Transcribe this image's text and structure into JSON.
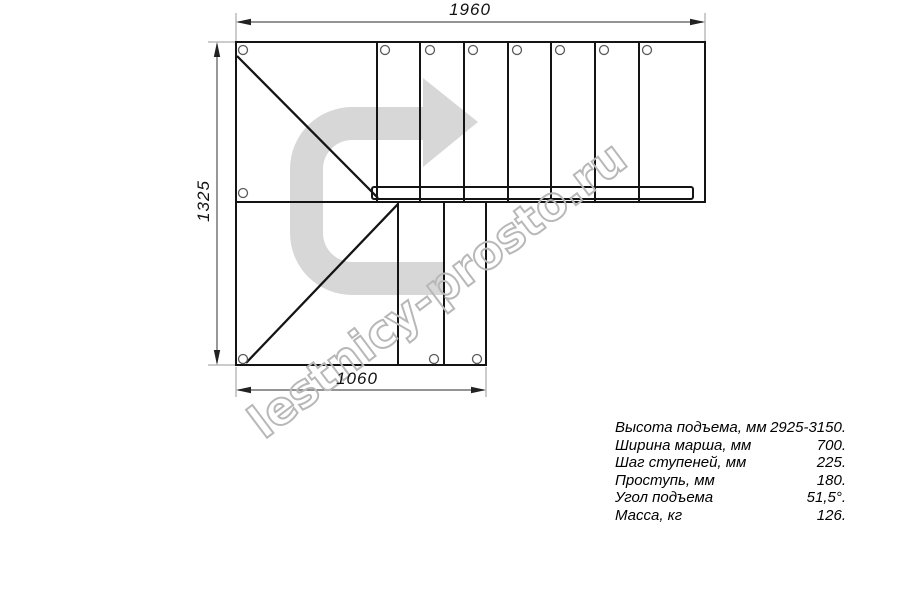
{
  "drawing": {
    "title": "Staircase plan view (L-shaped, top view)",
    "dimensions": {
      "top": "1960",
      "left": "1325",
      "bottom": "1060"
    },
    "watermark_text": "lestnicy-prosto.ru",
    "colors": {
      "line": "#141414",
      "arrow_watermark": "#d7d7d7",
      "watermark_outline": "#b8b8b8",
      "dimension_line": "#555555",
      "extension_line": "#9a9a9a"
    }
  },
  "specs": {
    "rows": [
      {
        "label": "Высота подъема, мм",
        "value": "2925-3150."
      },
      {
        "label": "Ширина марша, мм",
        "value": "700."
      },
      {
        "label": "Шаг ступеней, мм",
        "value": "225."
      },
      {
        "label": "Проступь, мм",
        "value": "180."
      },
      {
        "label": "Угол подъема",
        "value": "51,5°."
      },
      {
        "label": "Масса, кг",
        "value": "126."
      }
    ]
  }
}
